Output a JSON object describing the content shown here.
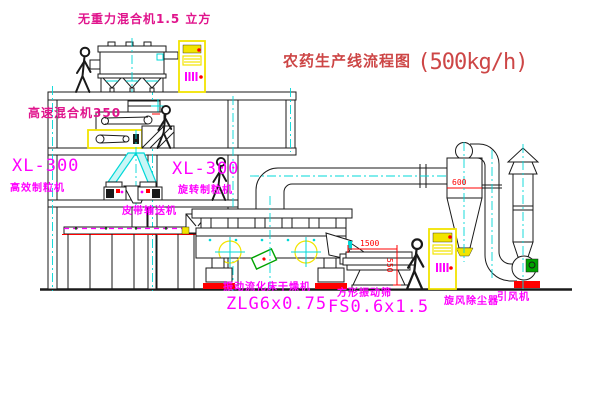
{
  "title": {
    "name": "农药生产线流程图",
    "capacity": "(500kg/h)"
  },
  "equipment_labels": {
    "gravity_mixer": "无重力混合机1.5 立方",
    "high_speed_mixer": "高速混合机350",
    "granulator_left_model": "XL-300",
    "granulator_left_name": "高效制粒机",
    "granulator_right_model": "XL-300",
    "granulator_right_name": "旋转制粒机",
    "belt_conveyor": "皮带输送机",
    "dryer_name": "振动流化床干燥机",
    "dryer_model": "ZLG6x0.75",
    "sieve_name": "方形振动筛",
    "sieve_model": "FS0.6x1.5",
    "cyclone": "旋风除尘器",
    "fan": "引风机"
  },
  "dimensions": {
    "sieve_length": "1500",
    "sieve_outlet_height": "550",
    "cyclone_diameter": "600"
  },
  "palette": {
    "line": "#1a1a1a",
    "magenta": "#ff00ff",
    "pink_red": "#e0148c",
    "title_red": "#cd4646",
    "dim_red": "#ff0000",
    "yellow": "#f2e400",
    "cyan": "#00d8d8",
    "green": "#00a300",
    "background": "#ffffff"
  }
}
